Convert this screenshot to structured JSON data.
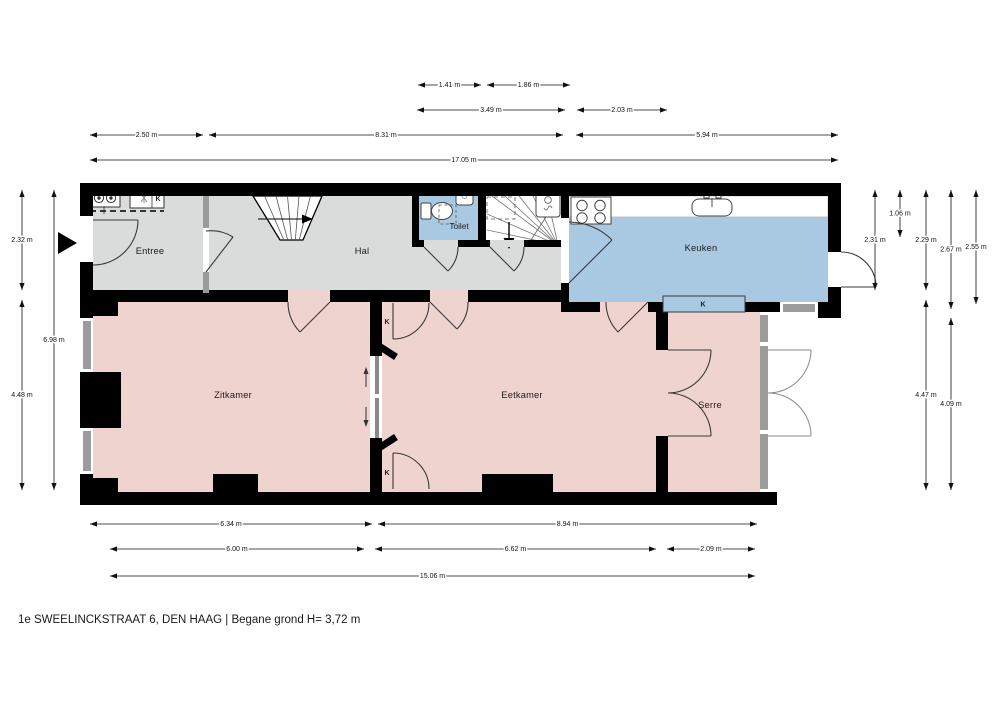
{
  "title": "1e SWEELINCKSTRAAT 6, DEN HAAG | Begane grond H= 3,72 m",
  "rooms": {
    "entree": "Entree",
    "hal": "Hal",
    "toilet": "Toilet",
    "keuken": "Keuken",
    "zitkamer": "Zitkamer",
    "eetkamer": "Eetkamer",
    "serre": "Serre"
  },
  "closets": {
    "entree_k": "K",
    "keuken_k": "K",
    "divider_top_k": "K",
    "divider_bottom_k": "K"
  },
  "colors": {
    "room_gray": "#d9dcda",
    "room_blue": "#a9c8e1",
    "room_pink": "#efd3cf",
    "wall": "#000000",
    "window": "#9b9b9b",
    "door": "#3a3a3a"
  },
  "dimensions": {
    "top": [
      {
        "label": "1.41 m",
        "x1": 418,
        "x2": 481,
        "y": 85
      },
      {
        "label": "1.86 m",
        "x1": 487,
        "x2": 570,
        "y": 85
      },
      {
        "label": "3.49 m",
        "x1": 417,
        "x2": 565,
        "y": 110
      },
      {
        "label": "2.03 m",
        "x1": 577,
        "x2": 667,
        "y": 110
      },
      {
        "label": "2.50 m",
        "x1": 90,
        "x2": 203,
        "y": 135
      },
      {
        "label": "8.31 m",
        "x1": 209,
        "x2": 563,
        "y": 135
      },
      {
        "label": "5.94 m",
        "x1": 576,
        "x2": 838,
        "y": 135
      },
      {
        "label": "17.05 m",
        "x1": 90,
        "x2": 838,
        "y": 160
      }
    ],
    "bottom": [
      {
        "label": "6.34 m",
        "x1": 90,
        "x2": 372,
        "y": 524
      },
      {
        "label": "8.94 m",
        "x1": 378,
        "x2": 757,
        "y": 524
      },
      {
        "label": "6.00 m",
        "x1": 110,
        "x2": 364,
        "y": 549
      },
      {
        "label": "6.62 m",
        "x1": 375,
        "x2": 656,
        "y": 549
      },
      {
        "label": "2.09 m",
        "x1": 667,
        "x2": 755,
        "y": 549
      },
      {
        "label": "15.06 m",
        "x1": 110,
        "x2": 755,
        "y": 576
      }
    ],
    "left": [
      {
        "label": "2.32 m",
        "x": 22,
        "y1": 190,
        "y2": 290
      },
      {
        "label": "4.48 m",
        "x": 22,
        "y1": 300,
        "y2": 490
      },
      {
        "label": "6.98 m",
        "x": 54,
        "y1": 190,
        "y2": 490
      }
    ],
    "right": [
      {
        "label": "2.31 m",
        "x": 875,
        "y1": 190,
        "y2": 290
      },
      {
        "label": "1.06 m",
        "x": 900,
        "y1": 190,
        "y2": 237
      },
      {
        "label": "2.29 m",
        "x": 926,
        "y1": 190,
        "y2": 290
      },
      {
        "label": "4.47 m",
        "x": 926,
        "y1": 300,
        "y2": 490
      },
      {
        "label": "2.67 m",
        "x": 951,
        "y1": 190,
        "y2": 309
      },
      {
        "label": "4.09 m",
        "x": 951,
        "y1": 318,
        "y2": 490
      },
      {
        "label": "2.55 m",
        "x": 976,
        "y1": 190,
        "y2": 304
      }
    ]
  }
}
